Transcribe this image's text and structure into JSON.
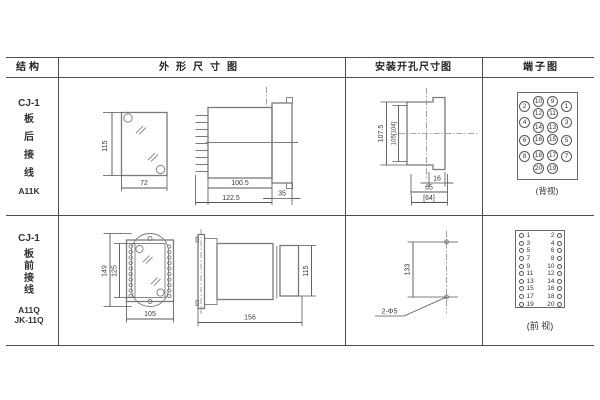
{
  "table": {
    "headers": {
      "structure": "结构",
      "outline": "外形尺寸图",
      "mounting": "安装开孔尺寸图",
      "terminal": "端子图"
    }
  },
  "rows": [
    {
      "structure_lines": [
        "CJ-1",
        "板",
        "后",
        "接",
        "线",
        "A11K"
      ],
      "outline": {
        "height": "115",
        "width": "72",
        "body_depth": "100.5",
        "total_depth": "122.5",
        "panel_thickness": "35"
      },
      "mounting": {
        "outer_height": "107.5",
        "inner_height": "105[104]",
        "slot_width": "16",
        "span": "65",
        "span_alt": "[64]"
      },
      "terminal_label": "(背视)"
    },
    {
      "structure_lines": [
        "CJ-1",
        "板",
        "前",
        "接",
        "线",
        "A11Q",
        "JK-11Q"
      ],
      "outline": {
        "plate_height": "149",
        "window_height": "125",
        "width": "105",
        "total_depth": "156",
        "height": "115"
      },
      "mounting": {
        "hole_spacing": "133",
        "hole_spec": "2-Φ5"
      },
      "terminal_label": "(前 视)"
    }
  ],
  "terminal_back": {
    "rows": [
      {
        "mid": [
          "10",
          "9"
        ],
        "left": "2",
        "right": "1"
      },
      {
        "mid": [
          "12",
          "11"
        ],
        "left": "4",
        "right": "3"
      },
      {
        "mid": [
          "14",
          "13"
        ]
      },
      {
        "mid": [
          "16",
          "15"
        ],
        "left": "6",
        "right": "5"
      },
      {
        "mid": [
          "18",
          "17"
        ],
        "left": "8",
        "right": "7"
      },
      {
        "mid": [
          "20",
          "19"
        ]
      }
    ]
  },
  "terminal_front": {
    "rows": [
      [
        "1",
        "2"
      ],
      [
        "3",
        "4"
      ],
      [
        "5",
        "6"
      ],
      [
        "7",
        "8"
      ],
      [
        "9",
        "10"
      ],
      [
        "11",
        "12"
      ],
      [
        "13",
        "14"
      ],
      [
        "15",
        "16"
      ],
      [
        "17",
        "18"
      ],
      [
        "19",
        "20"
      ]
    ]
  },
  "colors": {
    "table_line": "#4d4d4d",
    "drawing_line": "#7a7a7a",
    "text": "#333333"
  }
}
